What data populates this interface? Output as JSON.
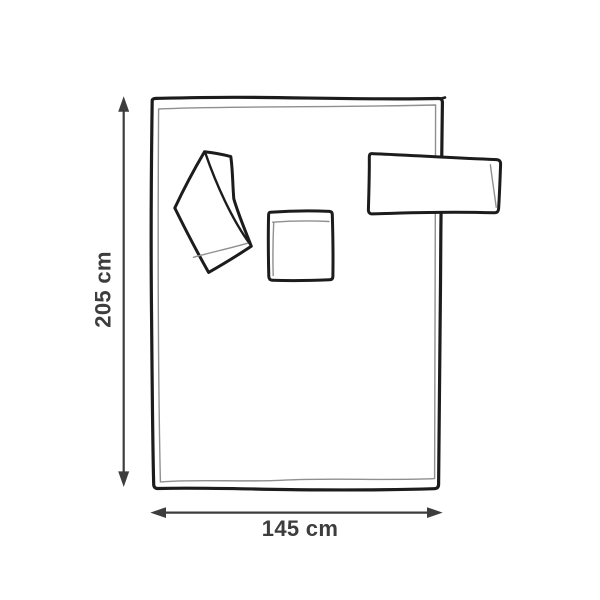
{
  "diagram": {
    "kind": "product-dimension-line-drawing",
    "parts": [
      "blanket",
      "folded-sleeve",
      "pocket",
      "sleeve-cuff"
    ],
    "colors": {
      "outline": "#1c1c1c",
      "seam": "#8f8f8f",
      "dimension": "#3d3d3d",
      "fill": "#ffffff"
    },
    "dimensions": {
      "height_label": "205 cm",
      "width_label": "145 cm"
    }
  }
}
